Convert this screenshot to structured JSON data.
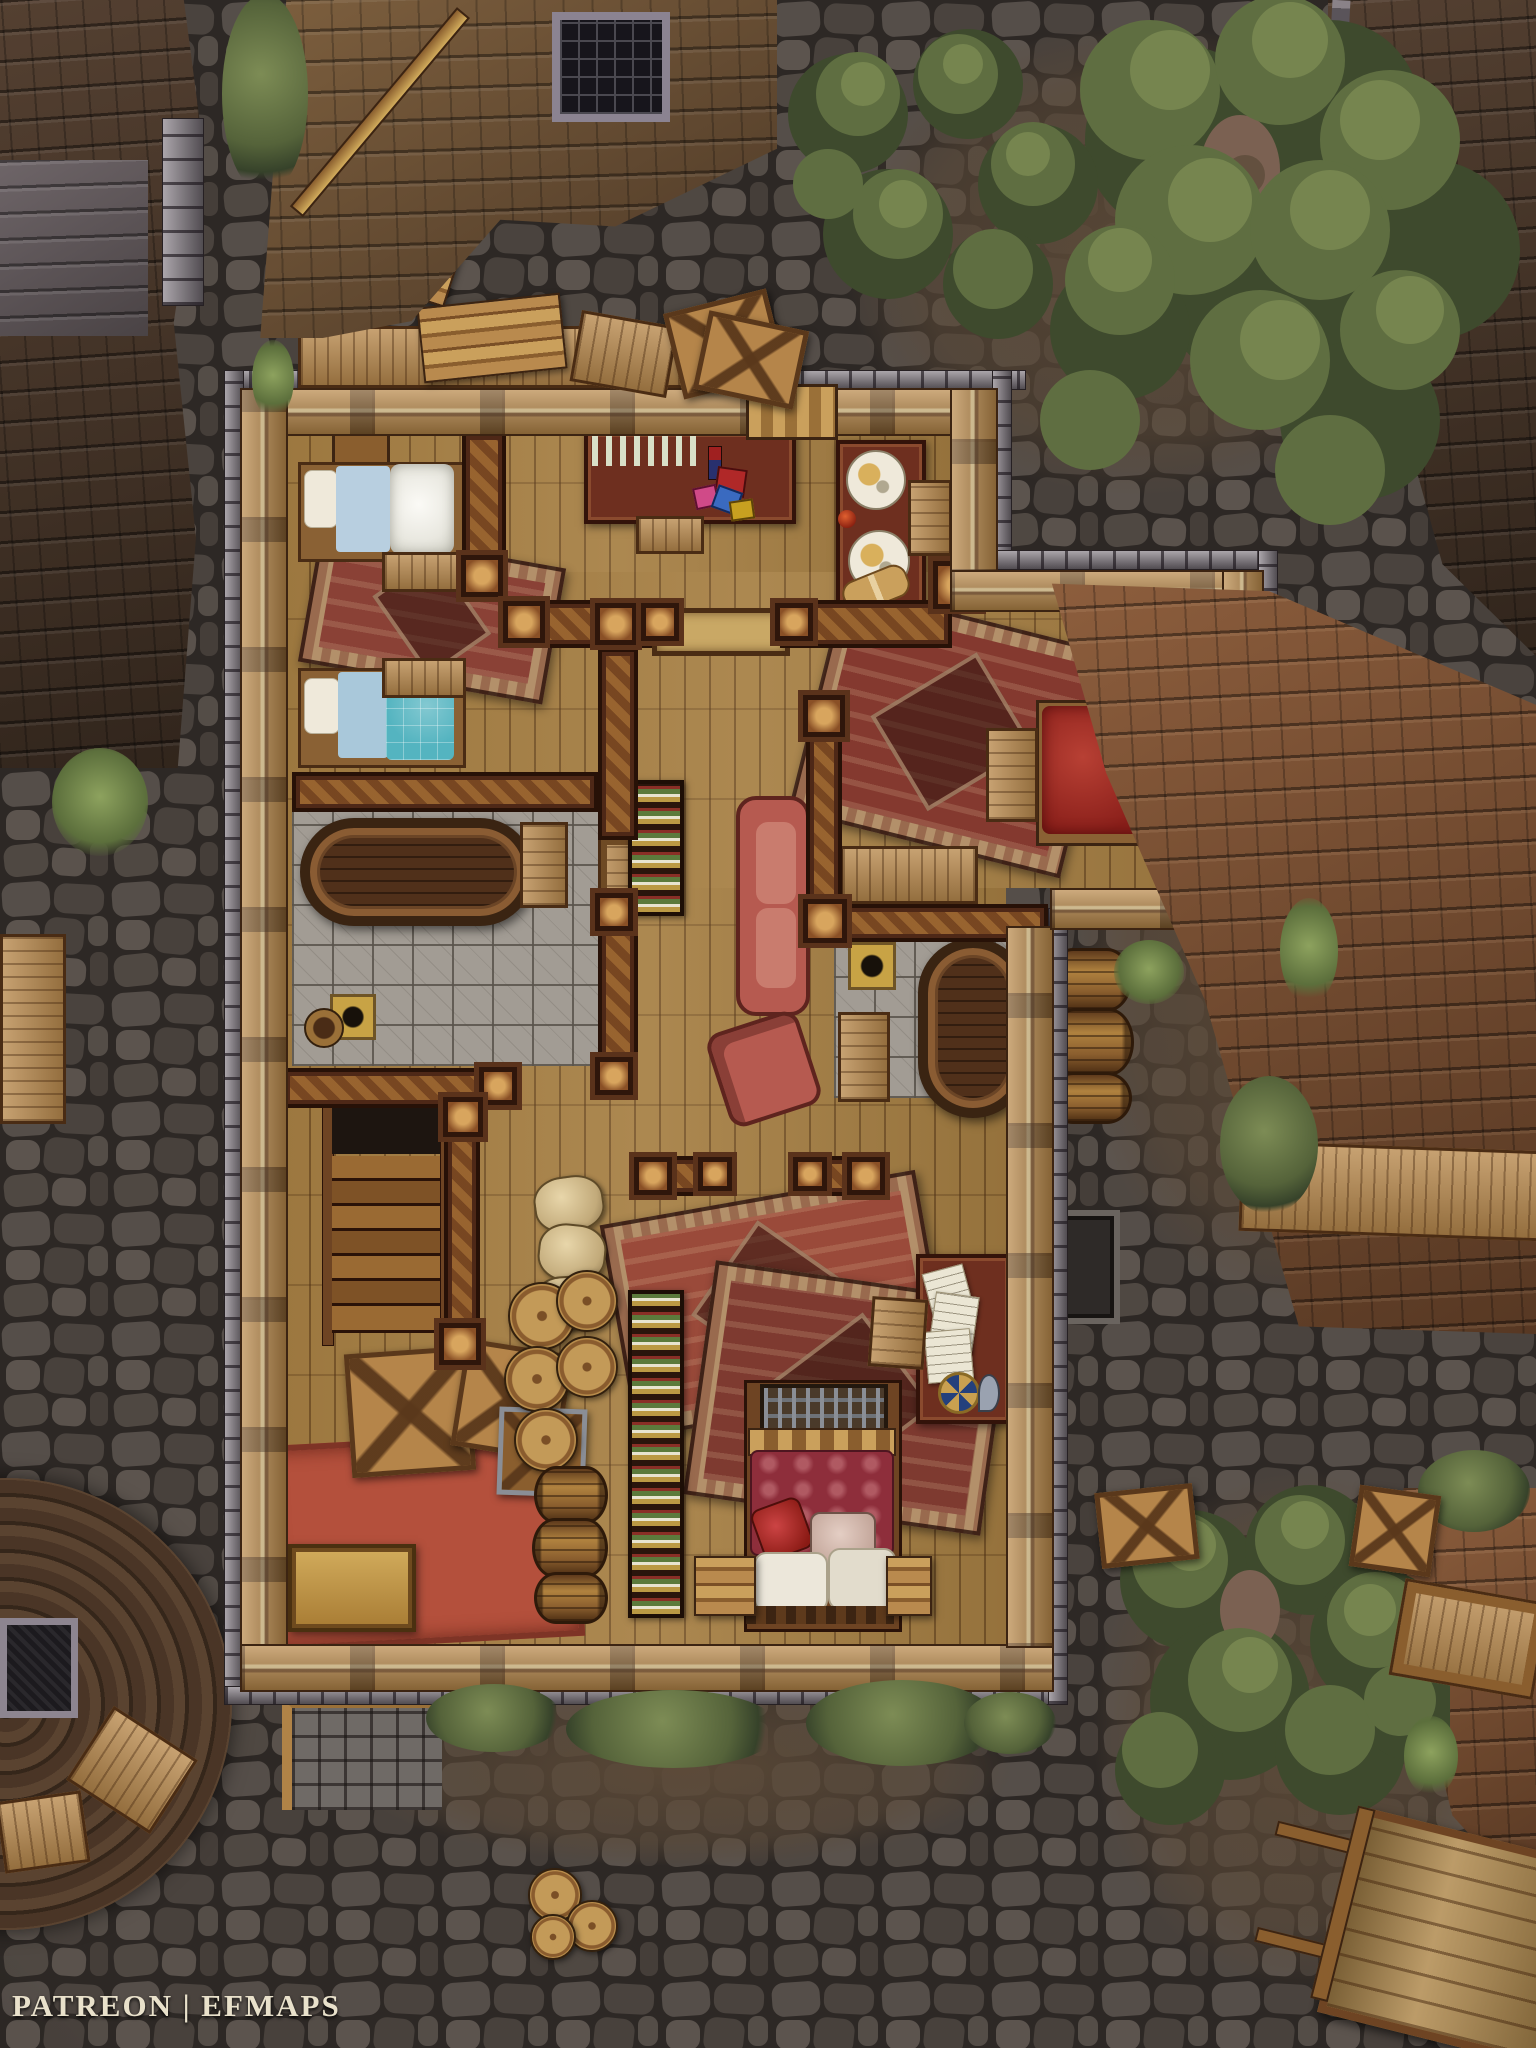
{
  "title": "Fantasy town house battle map",
  "watermark": {
    "text": "PATREON | EFMAPS"
  },
  "palette": {
    "ground-cobble": "#4e4742",
    "ground-joint": "#2c2724",
    "dirt": "#5a4837",
    "roof-dark": "#443328",
    "roof-mid": "#6d5339",
    "roof-copper": "#71462e",
    "roof-hut": "#4b3427",
    "stone": "#837b83",
    "wall-wood": "#b9894a",
    "floor-wood": "#a67f43",
    "beam": "#4e2817",
    "beam-accent": "#a06a32",
    "tile": "#a29c94",
    "tile-line": "#7b756d",
    "rug-tan": "#b3906a",
    "rug-red": "#8a4136",
    "rug-terracotta": "#b4503c",
    "bed-linen": "#f3f2ec",
    "bed-teal": "#54b4c0",
    "bed-sheet-blue": "#a9c8da",
    "bed-red": "#a13228",
    "quilt-crimson": "#8e2e3b",
    "couch-red": "#b65a50",
    "sack-tan": "#d6c193",
    "gold": "#c2a250",
    "paper": "#e9e4d2",
    "tree-green": "#5f6e41",
    "tree-green-light": "#76854f",
    "tree-green-dark": "#3e4a2d",
    "watermark-ink": "#e9e1cb"
  },
  "features": {
    "rooms": [
      "bedroom with two single beds",
      "washroom with long tub",
      "dining nook with food table",
      "bedroom with red double bed",
      "central hallway with couch and armchair",
      "washroom with round tub",
      "study corner with writing desk and papers",
      "storage with staircase, crates, sacks and barrels",
      "master bed nook with crimson quilt"
    ],
    "exterior": [
      "cobblestone streets",
      "neighboring shingle roofs",
      "round hut roof with chimney",
      "trees and bushes",
      "hand cart",
      "stacked barrels",
      "broken crates and plank debris",
      "wagon wheel",
      "stone stoop",
      "street lamp"
    ]
  }
}
